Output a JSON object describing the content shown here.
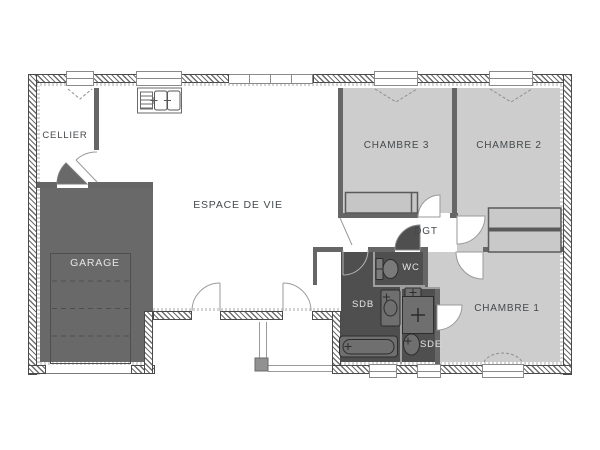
{
  "plan_title": "floor-plan",
  "rooms": {
    "cellier": "CELLIER",
    "garage": "GARAGE",
    "espace_de_vie": "ESPACE DE VIE",
    "chambre3": "CHAMBRE 3",
    "chambre2": "CHAMBRE 2",
    "chambre1": "CHAMBRE 1",
    "dgt": "DGT",
    "wc": "WC",
    "sdb": "SDB",
    "sde": "SDE"
  },
  "colors": {
    "room_light": "#cdcdcd",
    "room_dark": "#4f4f4f",
    "garage_fill": "#696969",
    "wall_dark": "#666666",
    "label_dark": "#45494c",
    "label_light": "#e6e6e6"
  }
}
